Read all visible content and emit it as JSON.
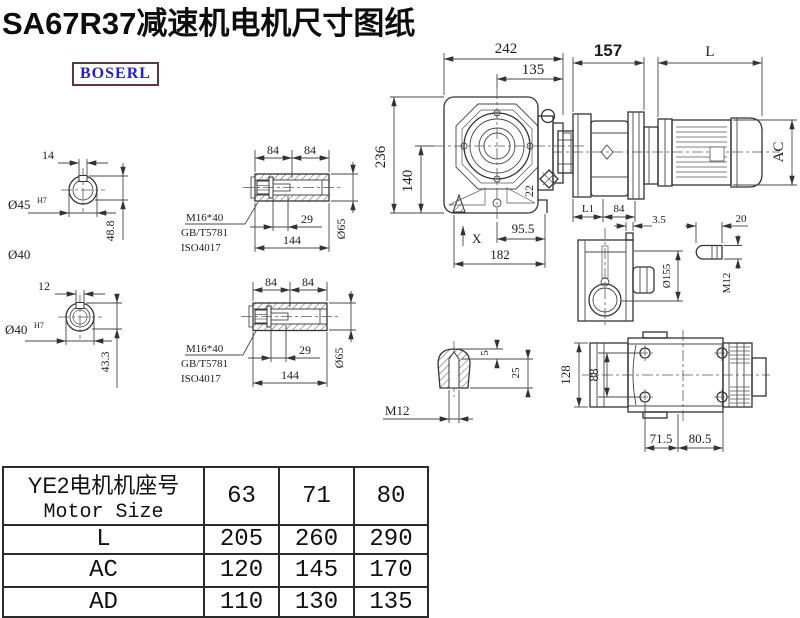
{
  "title": "SA67R37减速机电机尺寸图纸",
  "brand": "BOSERL",
  "labels": {
    "hole1": {
      "kw": "14",
      "bore": "Ø45",
      "tol": "H7",
      "depth": "48.8",
      "shaft": "Ø40"
    },
    "hole2": {
      "kw": "12",
      "bore": "Ø40",
      "tol": "H7",
      "depth": "43.3"
    },
    "sleeve": {
      "s1": "84",
      "s2": "84",
      "bolt": "M16*40",
      "std1": "GB/T5781",
      "std2": "ISO4017",
      "inset": "29",
      "len": "144",
      "dia": "Ø65"
    },
    "front": {
      "w": "242",
      "wc": "135",
      "h": "236",
      "hc": "140",
      "plug": "22",
      "xref": "X",
      "f1": "95.5",
      "f2": "182"
    },
    "side": {
      "total": "157",
      "motor": "L",
      "ac": "AC",
      "l1": "L1",
      "seg": "84"
    },
    "flange": {
      "step": "3.5",
      "dia": "Ø155",
      "key": "20",
      "thread": "M12"
    },
    "top": {
      "h": "128",
      "hc": "88",
      "w1": "71.5",
      "w2": "80.5"
    },
    "plug": {
      "tip": "5",
      "depth": "25",
      "thread": "M12"
    }
  },
  "table": {
    "header_cn": "YE2电机机座号",
    "header_en": "Motor Size",
    "cols": [
      "63",
      "71",
      "80"
    ],
    "rows": [
      {
        "label": "L",
        "values": [
          "205",
          "260",
          "290"
        ]
      },
      {
        "label": "AC",
        "values": [
          "120",
          "145",
          "170"
        ]
      },
      {
        "label": "AD",
        "values": [
          "110",
          "130",
          "135"
        ]
      }
    ]
  }
}
